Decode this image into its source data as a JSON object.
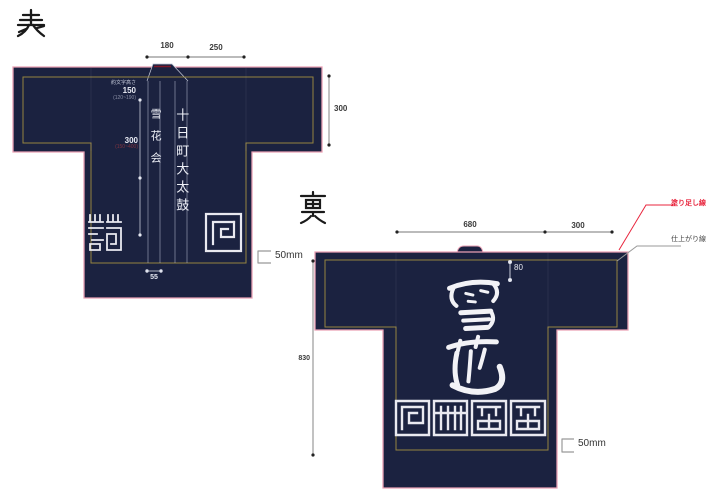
{
  "front": {
    "side_label": "表",
    "dim_collar_width": "180",
    "dim_shoulder": "250",
    "dim_sleeve_depth": "300",
    "char_height_label": "約文字高さ",
    "char_height_value": "150",
    "char_height_range": "(120~190)",
    "body_offset_value": "300",
    "body_offset_range": "(150~400)",
    "lapel_right_text": "十日町大太鼓",
    "lapel_left_text": "雪花会",
    "dim_lapel_width": "55",
    "offset_label": "50mm"
  },
  "back": {
    "side_label": "裏",
    "dim_width": "680",
    "dim_sleeve": "300",
    "dim_top_margin": "80",
    "dim_height": "830",
    "calligraphy_text": "雪花",
    "offset_label": "50mm"
  },
  "annotations": {
    "bleed_line_label": "塗り足し線",
    "finish_line_label": "仕上がり線"
  },
  "colors": {
    "coat_navy": "#1b2240",
    "bleed_pink": "#e9a0b4",
    "finish_gold": "#9c8a40",
    "annotation_red": "#e8243c",
    "emblem_white": "#e9e9f0"
  }
}
